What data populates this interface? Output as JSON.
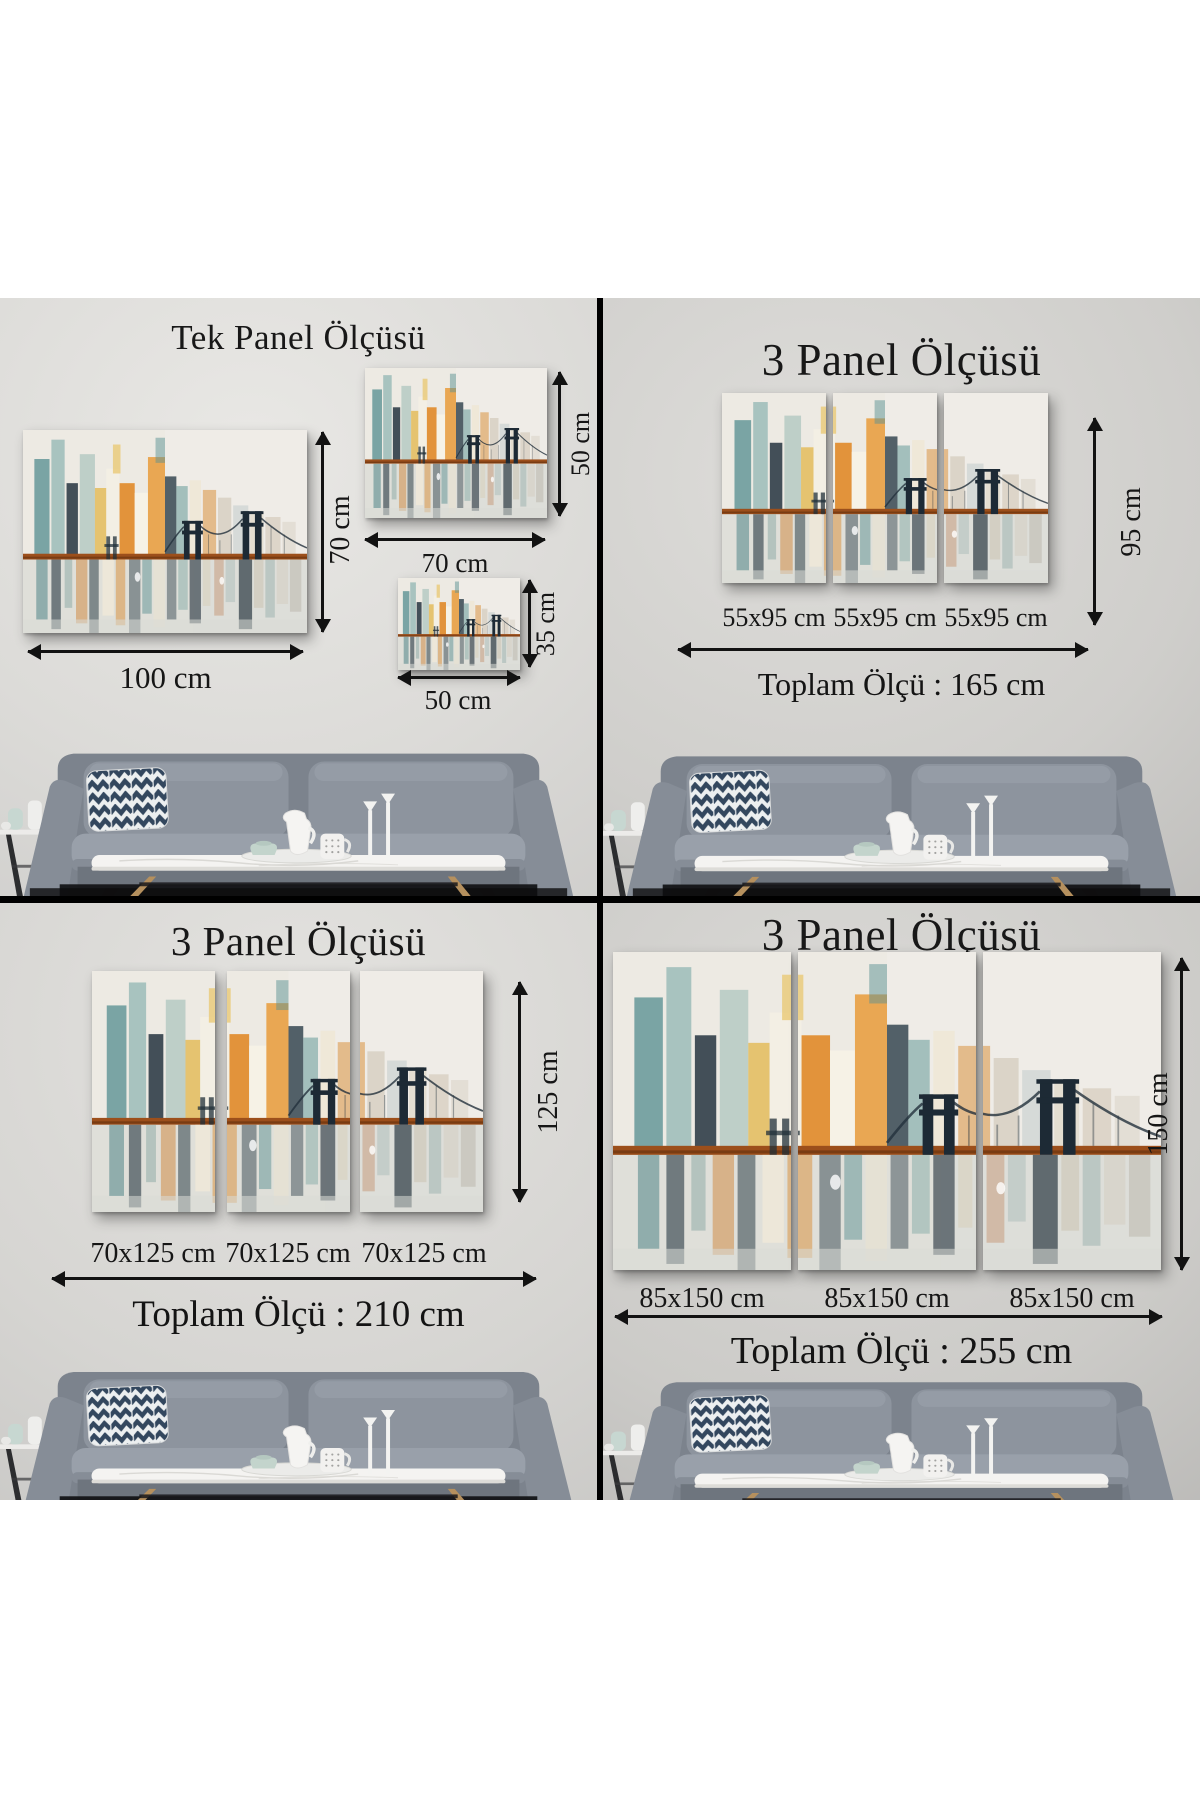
{
  "page": {
    "background": "#ffffff",
    "divider_color": "#000000"
  },
  "colors": {
    "wall_gray": "#d6d5d3",
    "arrow_black": "#121212",
    "text_black": "#171717",
    "canvas_base": "#efece4",
    "painting_teal": "#5c9294",
    "painting_orange": "#e08a28",
    "painting_dark_navy": "#1d2a35",
    "bridge_deck": "#9c4f1b",
    "sofa_gray": "#8a919b",
    "pillow_navy": "#33475e",
    "table_marble": "#f4f3f1"
  },
  "quadrants": {
    "tek_panel": {
      "title": "Tek Panel Ölçüsü",
      "large": {
        "width_label": "100 cm",
        "height_label": "70 cm"
      },
      "medium": {
        "width_label": "70 cm",
        "height_label": "50 cm"
      },
      "small": {
        "width_label": "50 cm",
        "height_label": "35 cm"
      }
    },
    "panel3_95": {
      "title": "3 Panel Ölçüsü",
      "height_label": "95 cm",
      "panel_labels": [
        "55x95 cm",
        "55x95 cm",
        "55x95 cm"
      ],
      "total_label": "Toplam Ölçü : 165 cm"
    },
    "panel3_125": {
      "title": "3 Panel Ölçüsü",
      "height_label": "125 cm",
      "panel_labels": [
        "70x125 cm",
        "70x125 cm",
        "70x125 cm"
      ],
      "total_label": "Toplam Ölçü : 210 cm"
    },
    "panel3_150": {
      "title": "3 Panel Ölçüsü",
      "height_label": "150 cm",
      "panel_labels": [
        "85x150 cm",
        "85x150 cm",
        "85x150 cm"
      ],
      "total_label": "Toplam Ölçü : 255 cm"
    }
  }
}
